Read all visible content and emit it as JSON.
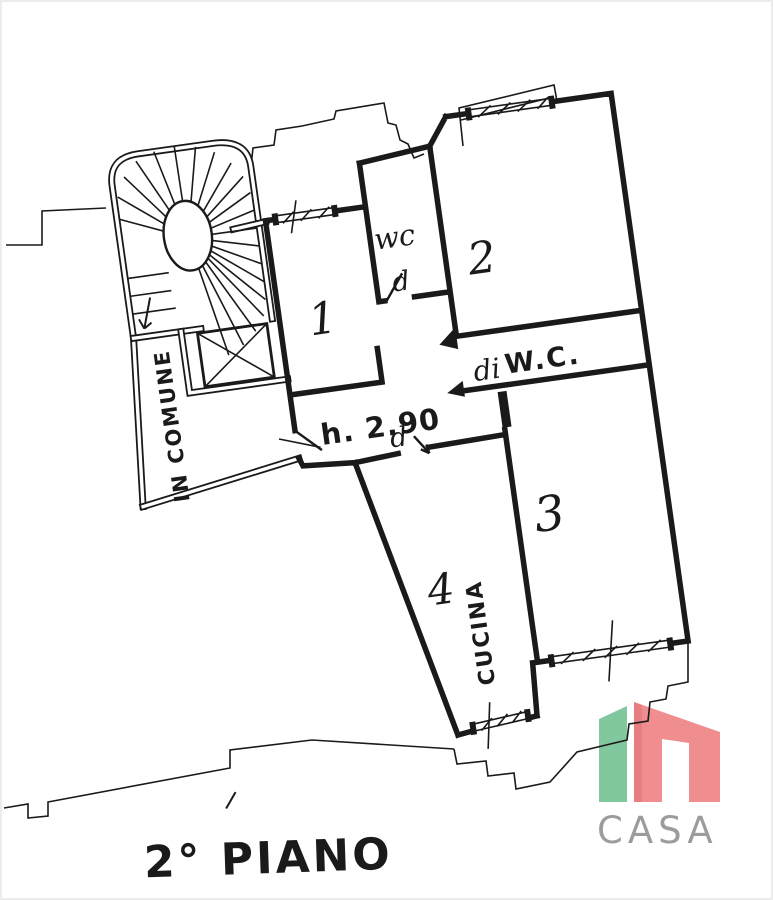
{
  "plan": {
    "ink_color": "#1a1a1a",
    "floor_label": "2° PIANO",
    "common_area_label": "IN COMUNE",
    "kitchen_label": "CUCINA",
    "height_label": "h. 2.90",
    "wc_room_label": "wc",
    "corridor_wc_prefix": "di",
    "corridor_wc_label": "W.C.",
    "wc_door_letter": "d",
    "hall_door_letter": "d",
    "rooms": {
      "room1": "1",
      "room2": "2",
      "room3": "3",
      "room4": "4"
    }
  },
  "logo": {
    "text": "CASA",
    "green": "#82c89e",
    "pink": "#ef8d8f",
    "pink_dark": "#e87e82",
    "text_color": "#9c9c9c"
  }
}
